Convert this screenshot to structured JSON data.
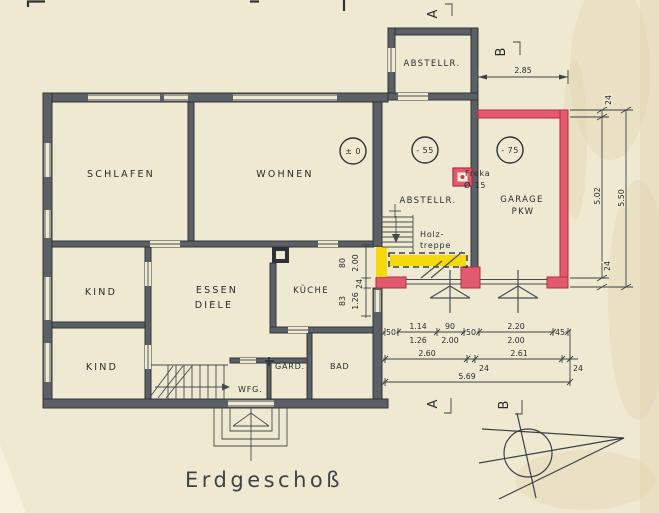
{
  "title": "Erdgeschoß",
  "rooms": {
    "schlafen": "SCHLAFEN",
    "wohnen": "WOHNEN",
    "kind1": "KIND",
    "kind2": "KIND",
    "essen": "ESSEN",
    "diele": "DIELE",
    "kueche": "KÜCHE",
    "wfg": "WFG.",
    "gard": "GARD.",
    "bad": "BAD",
    "abstellr_top": "ABSTELLR.",
    "abstellr_mid": "ABSTELLR.",
    "garage": "GARAGE",
    "garage_sub": "PKW"
  },
  "levels": {
    "main": "± 0",
    "abstell": "- 55",
    "garage": "- 75"
  },
  "notes": {
    "freka_name": "Freka",
    "freka_size": "Ø 15",
    "stair_line1": "Holz-",
    "stair_line2": "treppe"
  },
  "sections": {
    "a": "A",
    "b": "B"
  },
  "dims": {
    "garage_width": "2.85",
    "right": {
      "wall_top": "24",
      "inner": "5.02",
      "outer": "5.50",
      "wall_bottom": "24"
    },
    "left_col": {
      "w80": "80",
      "w200": "2.00",
      "w24": "24",
      "w83": "83",
      "w126": "1.26"
    },
    "row1": [
      "50",
      "1.14",
      "1.26",
      "90",
      "2.00",
      "50",
      "2.20",
      "2.00",
      "45"
    ],
    "row2": [
      "2.60",
      "24",
      "2.61",
      "24"
    ],
    "total": "5.69"
  },
  "colors": {
    "paper": "#f0e9d2",
    "ink": "#33383c",
    "wall_fill": "#5a6065",
    "garage_red": "#e25a6e",
    "highlight_yellow": "#f4d90c"
  }
}
